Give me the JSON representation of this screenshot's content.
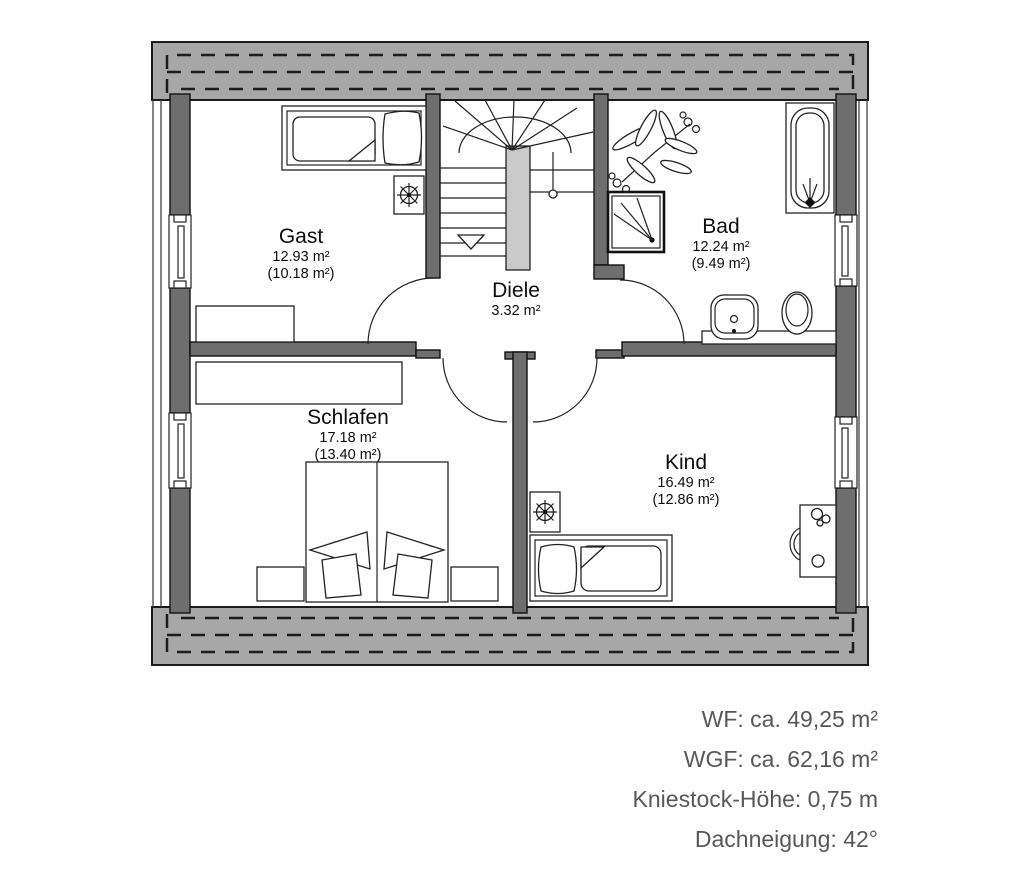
{
  "rooms": {
    "gast": {
      "name": "Gast",
      "area": "12.93 m²",
      "area_reduced": "(10.18 m²)"
    },
    "diele": {
      "name": "Diele",
      "area": "3.32 m²"
    },
    "bad": {
      "name": "Bad",
      "area": "12.24 m²",
      "area_reduced": "(9.49 m²)"
    },
    "schlafen": {
      "name": "Schlafen",
      "area": "17.18 m²",
      "area_reduced": "(13.40 m²)"
    },
    "kind": {
      "name": "Kind",
      "area": "16.49 m²",
      "area_reduced": "(12.86 m²)"
    }
  },
  "stats": {
    "wf": "WF: ca. 49,25 m²",
    "wgf": "WGF: ca. 62,16 m²",
    "kniestock": "Kniestock-Höhe: 0,75 m",
    "dachneigung": "Dachneigung: 42°"
  },
  "symbols": [
    "staircase",
    "stair-direction-arrow",
    "door-swing",
    "window",
    "bathtub",
    "shower",
    "washbasin",
    "toilet",
    "plant",
    "single-bed",
    "double-bed",
    "nightstand",
    "dresser",
    "sideboard",
    "desk",
    "chair"
  ],
  "colors": {
    "roof_overhang": "#a7a7a7",
    "wall": "#6e6e6e",
    "stair_spine": "#c9c9c9",
    "line": "#111111",
    "stats_text": "#58585a",
    "background": "#ffffff"
  }
}
